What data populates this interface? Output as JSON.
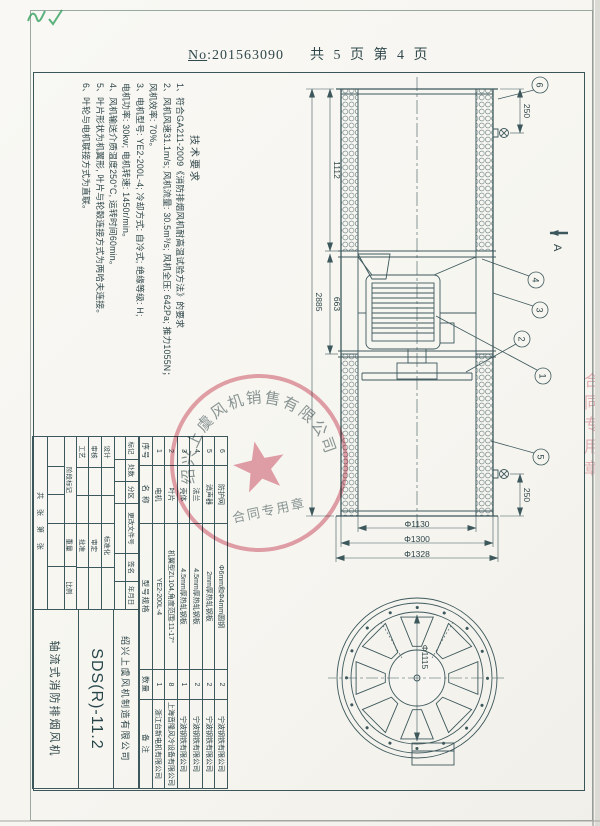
{
  "page": {
    "no_prefix": "No",
    "no_rest": ":201563090",
    "pages": "共 5 页  第 4 页"
  },
  "tech": {
    "title": "技术要求",
    "lines": [
      "1、符合GA211-2009《消防排烟风机耐高温试验方法》的要求",
      "2、风机风速31.1m/s; 风机流量: 30.5m³/s; 风机全压: 642Pa; 推力1055N；",
      "风机效率: 70%。",
      "3、电机型号: YE2-200L-4; 冷却方式: 自冷式; 绝缘等级: H;",
      "电机功率: 30kw; 电机转速: 1450r/min。",
      "4、风机输送介质温度250°C, 运转时间60min。",
      "5、叶片形状为机翼形, 叶片与轮毂连接方式为两哈夫连接。",
      "6、叶轮与电机联接方式为直联。"
    ]
  },
  "drawing": {
    "dims": {
      "overall": "2885",
      "left_section": "1112",
      "mid_section": "663",
      "lug_left": "250",
      "lug_right": "250",
      "d_inner": "Φ1130",
      "d_shell": "Φ1300",
      "d_flange": "Φ1328",
      "d_impeller": "Φ1115"
    },
    "section_label": "A",
    "balloons": [
      "1",
      "2",
      "3",
      "4",
      "5",
      "6"
    ]
  },
  "bom": {
    "headers": [
      "序号",
      "名  称",
      "型号规格",
      "数量",
      "备  注"
    ],
    "rows": [
      [
        "1",
        "电机",
        "YE2-200L-4",
        "1",
        "浙江台新电机有限公司"
      ],
      [
        "2",
        "叶片",
        "机翼型ZL104,角度范围:11-17°",
        "8",
        "上海音隆风冷设备有限公司"
      ],
      [
        "3",
        "壳体",
        "4.5mm厚热轧钢板",
        "1",
        "宁波钢铁有限公司"
      ],
      [
        "4",
        "法兰",
        "4.5mm厚热轧钢板",
        "2",
        "宁波钢铁有限公司"
      ],
      [
        "5",
        "消声器",
        "2mm厚热轧钢板",
        "2",
        "宁波钢铁有限公司"
      ],
      [
        "6",
        "防护网",
        "Φ6mm和Φ4mm圆钢",
        "2",
        "宁波钢铁有限公司"
      ]
    ]
  },
  "titleblock": {
    "rev_headers": [
      "标记",
      "处数",
      "分区",
      "更改文件号",
      "签名",
      "年月日"
    ],
    "sign_left": [
      "设计",
      "审核",
      "工艺"
    ],
    "sign_right": [
      "标准化",
      "审定",
      "批准"
    ],
    "stage": [
      "阶段标记",
      "重量",
      "比例"
    ],
    "sheets": "共  张  第  张",
    "company": "绍兴上虞风机制造有限公司",
    "code": "SDS(R)-11.2",
    "product": "轴流式消防排烟风机"
  },
  "stamp": {
    "ring": "绍兴上虞风机销售有限公司",
    "banner": "合同专用章"
  },
  "side_stamp": {
    "text": "合同专用章"
  },
  "colors": {
    "line": "#3d585c",
    "stamp_red": "#d4566b",
    "paper": "#f7f5f1",
    "check_green": "#35a05f"
  }
}
